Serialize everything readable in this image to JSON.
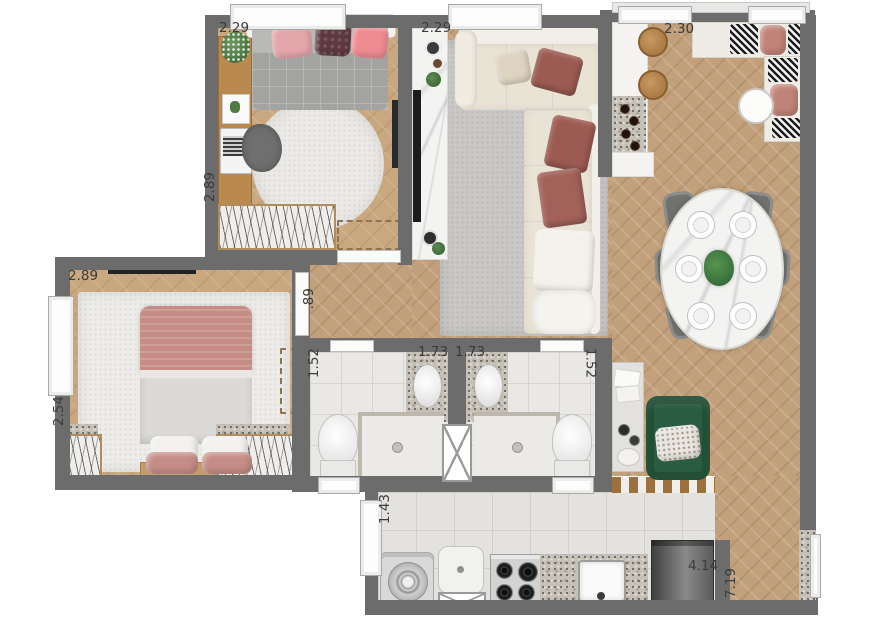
{
  "plan": {
    "type": "residential-apartment-floor-plan",
    "view": "top-down-rendered",
    "unit_hint": "meters"
  },
  "dimensions": {
    "bedroom1_width": "2.29",
    "bedroom1_depth": "2.89",
    "living_width": "2.29",
    "gourmet_width": "2.30",
    "bedroom2_width": "2.89",
    "bedroom2_depth": "2.54",
    "hall_width": ".89",
    "bath1_depth": "1.52",
    "bath1_width": "1.73",
    "bath2_width": "1.73",
    "bath2_depth": "1.52",
    "service_depth": "1.43",
    "kitchen_width": "4.14",
    "right_wing_depth": "7.19"
  },
  "colors": {
    "wall": "#6c6c6c",
    "wood_floor": "#c2a07b",
    "bedroom_floor": "#c9a87f",
    "tile_floor": "#e3e2df",
    "sofa_cream": "#e9e3d6",
    "accent_burgundy": "#9c5b52",
    "accent_rose": "#c58d86",
    "armchair_green": "#2a5c41",
    "label_text": "#3b3b3b"
  }
}
